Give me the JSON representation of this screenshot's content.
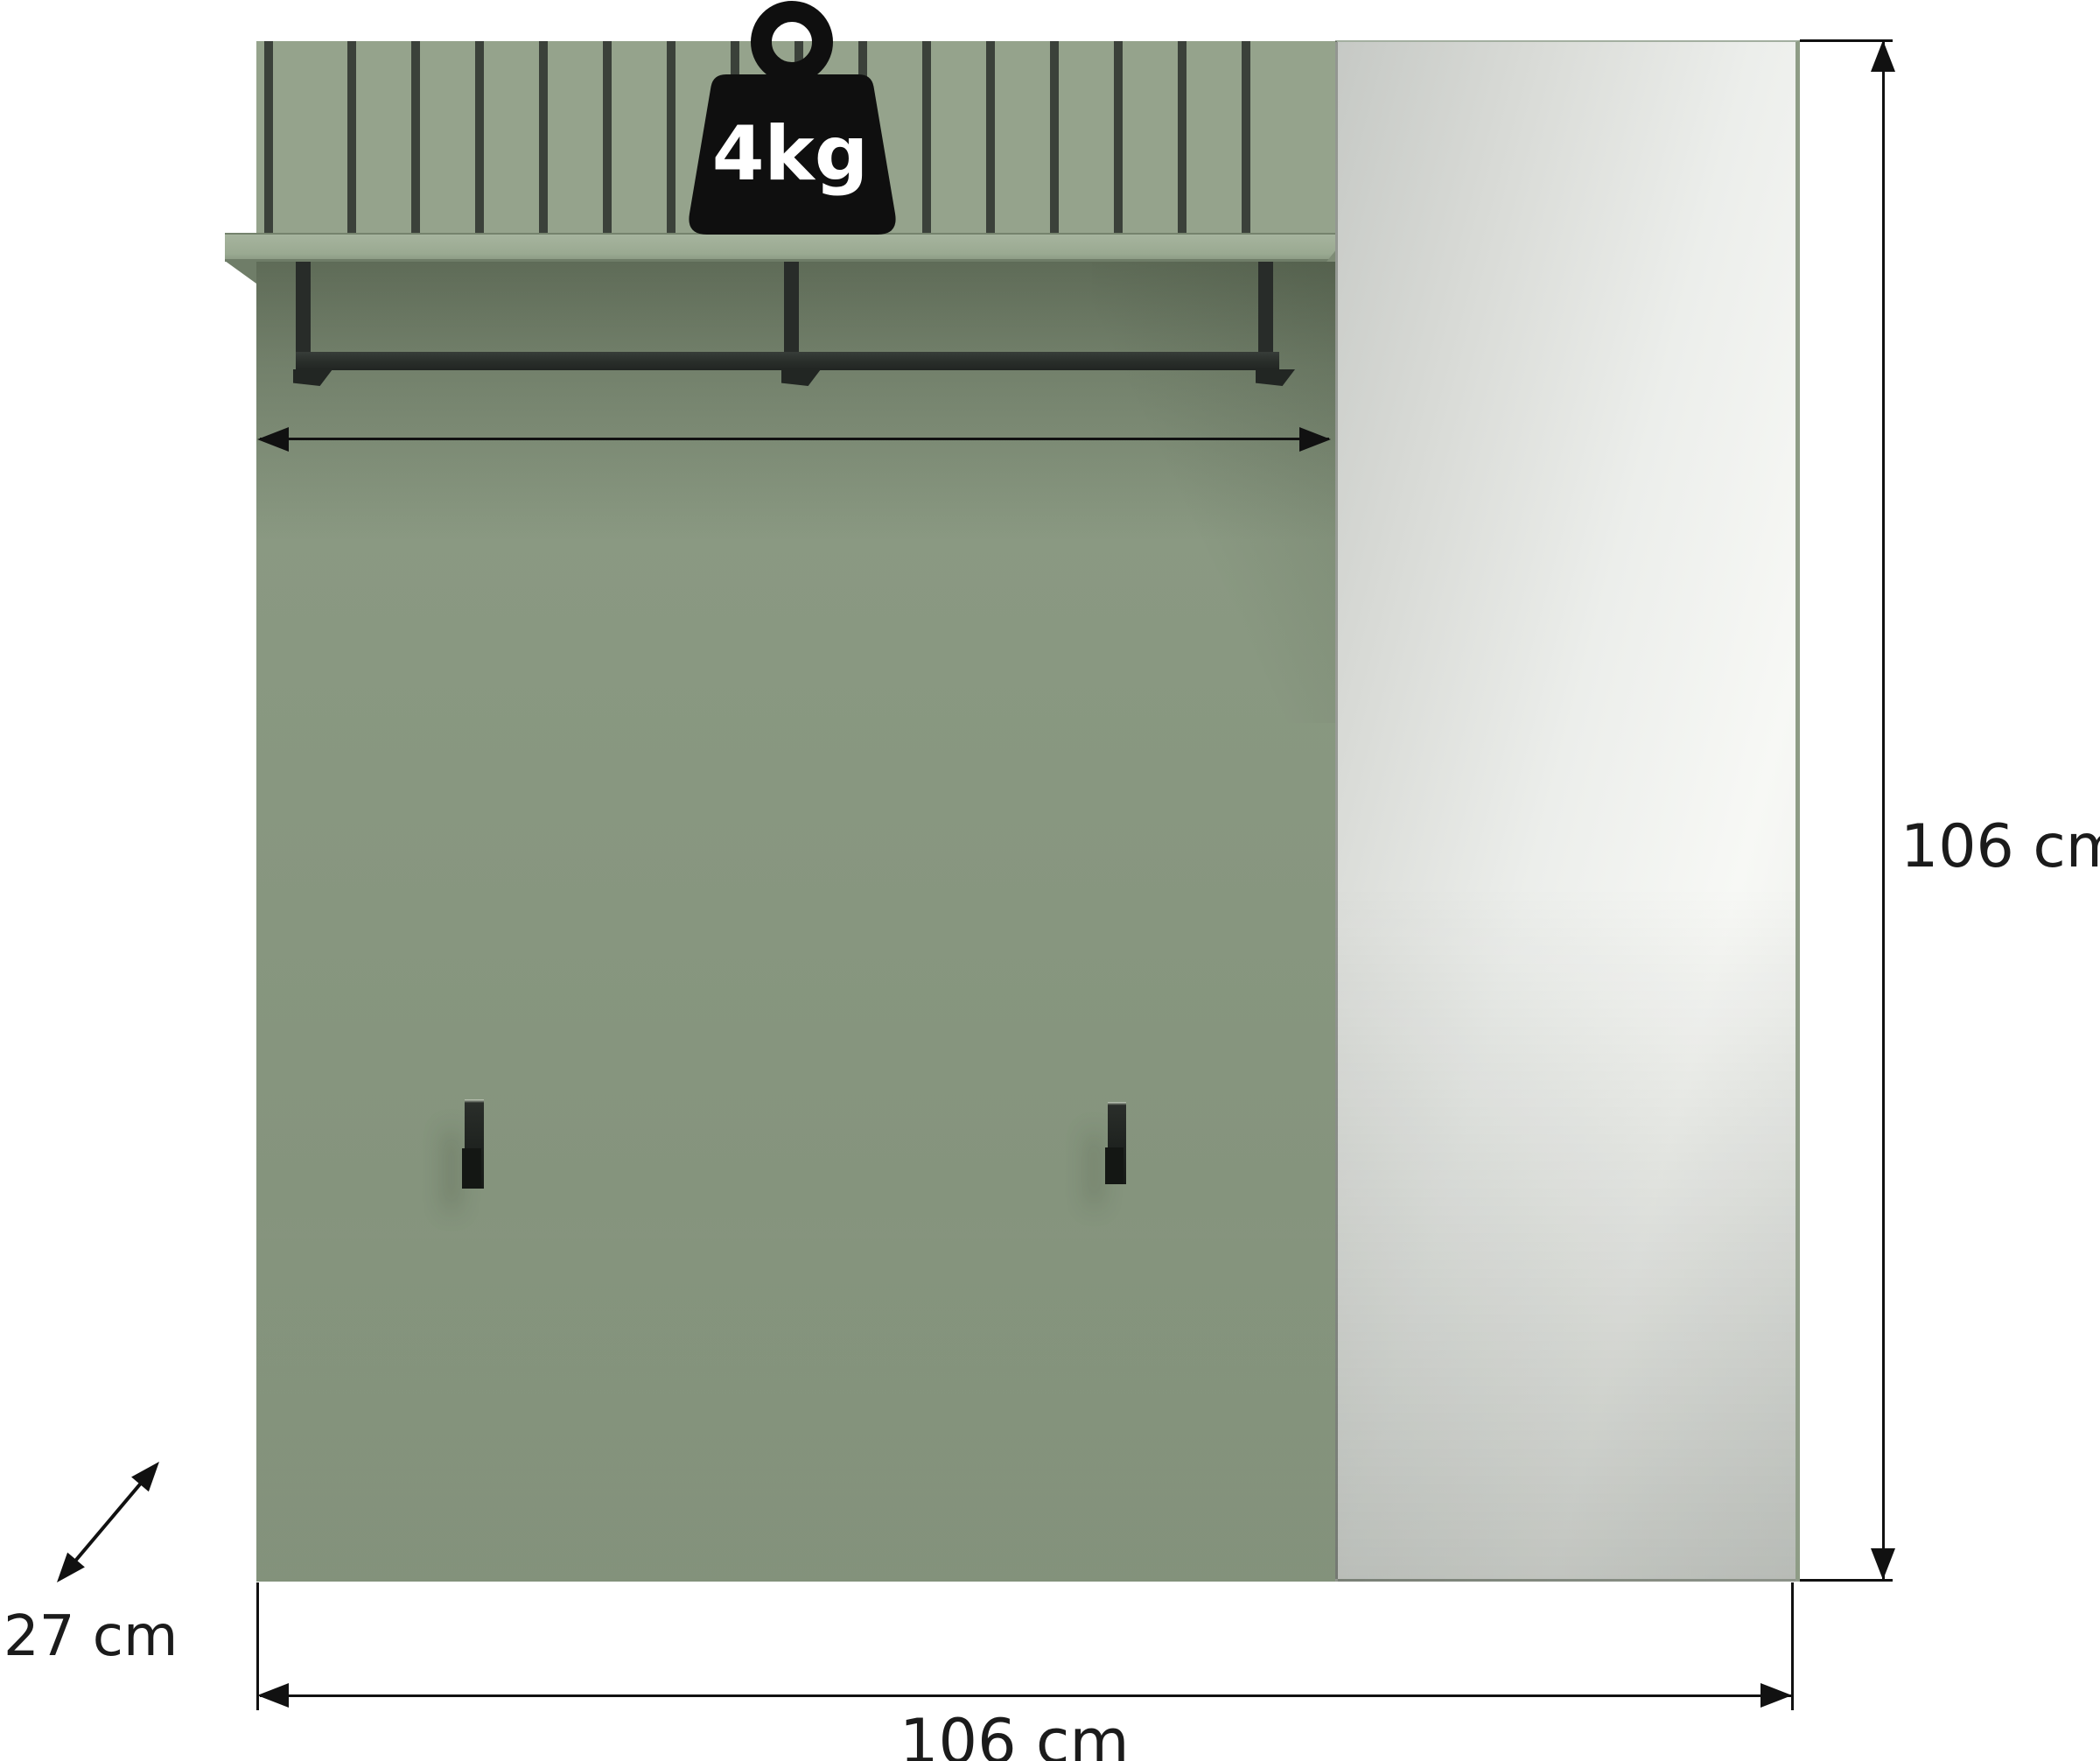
{
  "figure": {
    "alt": "Dimension diagram of a wall-mounted hallway coat rack panel with slatted top, shelf, coat rail, two hooks and a mirror"
  },
  "labels": {
    "weight_capacity": "4kg",
    "height": "106 cm",
    "width": "106 cm",
    "depth": "27 cm"
  },
  "icons": {
    "weight_icon": "kettlebell-weight-icon",
    "height_arrow": "double-headed-vertical-arrow",
    "width_arrow": "double-headed-horizontal-arrow",
    "depth_arrow": "double-headed-diagonal-arrow",
    "rail_width_arrow": "double-headed-horizontal-arrow"
  },
  "colors": {
    "background": "#ffffff",
    "panel-green": "#8b9a83",
    "slat-green": "#95a38c",
    "groove-dark": "#3b413a",
    "shelf-green": "#a2b099",
    "metal-dark": "#2a2e2b",
    "hook-black": "#1a1d1a",
    "icon-black": "#0f0f0f",
    "badge-text": "#ffffff",
    "mirror-light": "#f7f8f5",
    "mirror-dark": "#c6c9c5",
    "mirror-edge-green": "#8e9c86",
    "line-color": "#111111",
    "label-color": "#1b1b1b"
  }
}
